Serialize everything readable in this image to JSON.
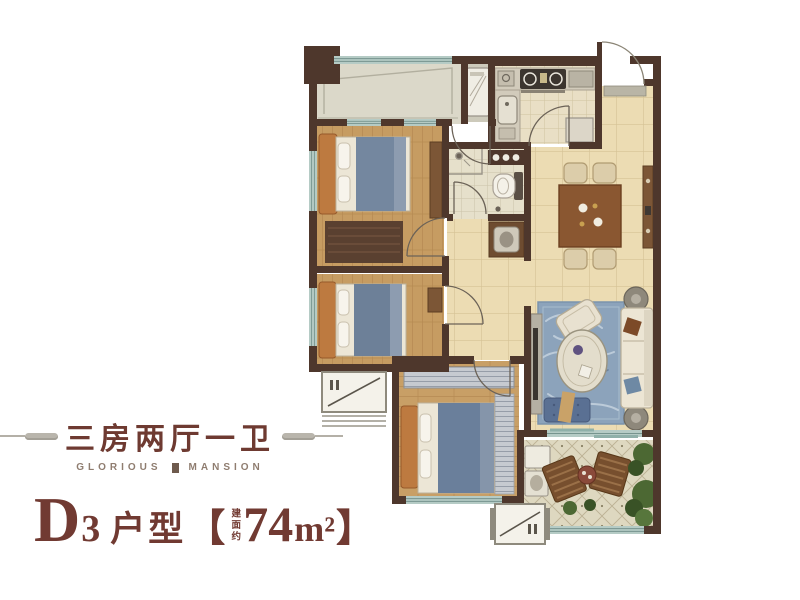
{
  "panel": {
    "title": "三房两厅一卫",
    "brand_left": "GLORIOUS",
    "brand_right": "MANSION",
    "unit_letter": "D",
    "unit_digit": "3",
    "unit_type_label": "户型",
    "bracket_open": "【",
    "bracket_close": "】",
    "area_prefix": "建面约",
    "area_number": "74",
    "area_unit": "m²"
  },
  "palette": {
    "accent_maroon": "#713a32",
    "brand_gray": "#8f7d70",
    "ornament_gray": "#b4b0a7",
    "wall_brown": "#4e372c",
    "window_teal": "#b5cbc5",
    "tile_beige": "#ecdcb3",
    "wood_tan": "#c69c62",
    "rug_blue": "#8ca3bb",
    "balcony_gray": "#dbd8c9"
  },
  "floor_plan": {
    "rooms": [
      "north-balcony",
      "kitchen",
      "entry",
      "bedroom-1",
      "bedroom-2",
      "bathroom",
      "dining-area",
      "living-room",
      "master-bedroom",
      "south-balcony"
    ],
    "icons": [
      "double-bed-icon",
      "sofa-icon",
      "coffee-table-icon",
      "armchair-icon",
      "tv-console-icon",
      "dining-table-icon",
      "dining-chair-icon",
      "console-table-icon",
      "toilet-icon",
      "shower-icon",
      "washbasin-icon",
      "vanity-icon",
      "stove-icon",
      "kitchen-sink-icon",
      "washing-machine-icon",
      "refrigerator-icon",
      "lounge-chair-icon",
      "patio-table-icon",
      "plant-icon",
      "ac-unit-icon",
      "door-swing-icon",
      "window-icon",
      "doormat-icon"
    ]
  }
}
